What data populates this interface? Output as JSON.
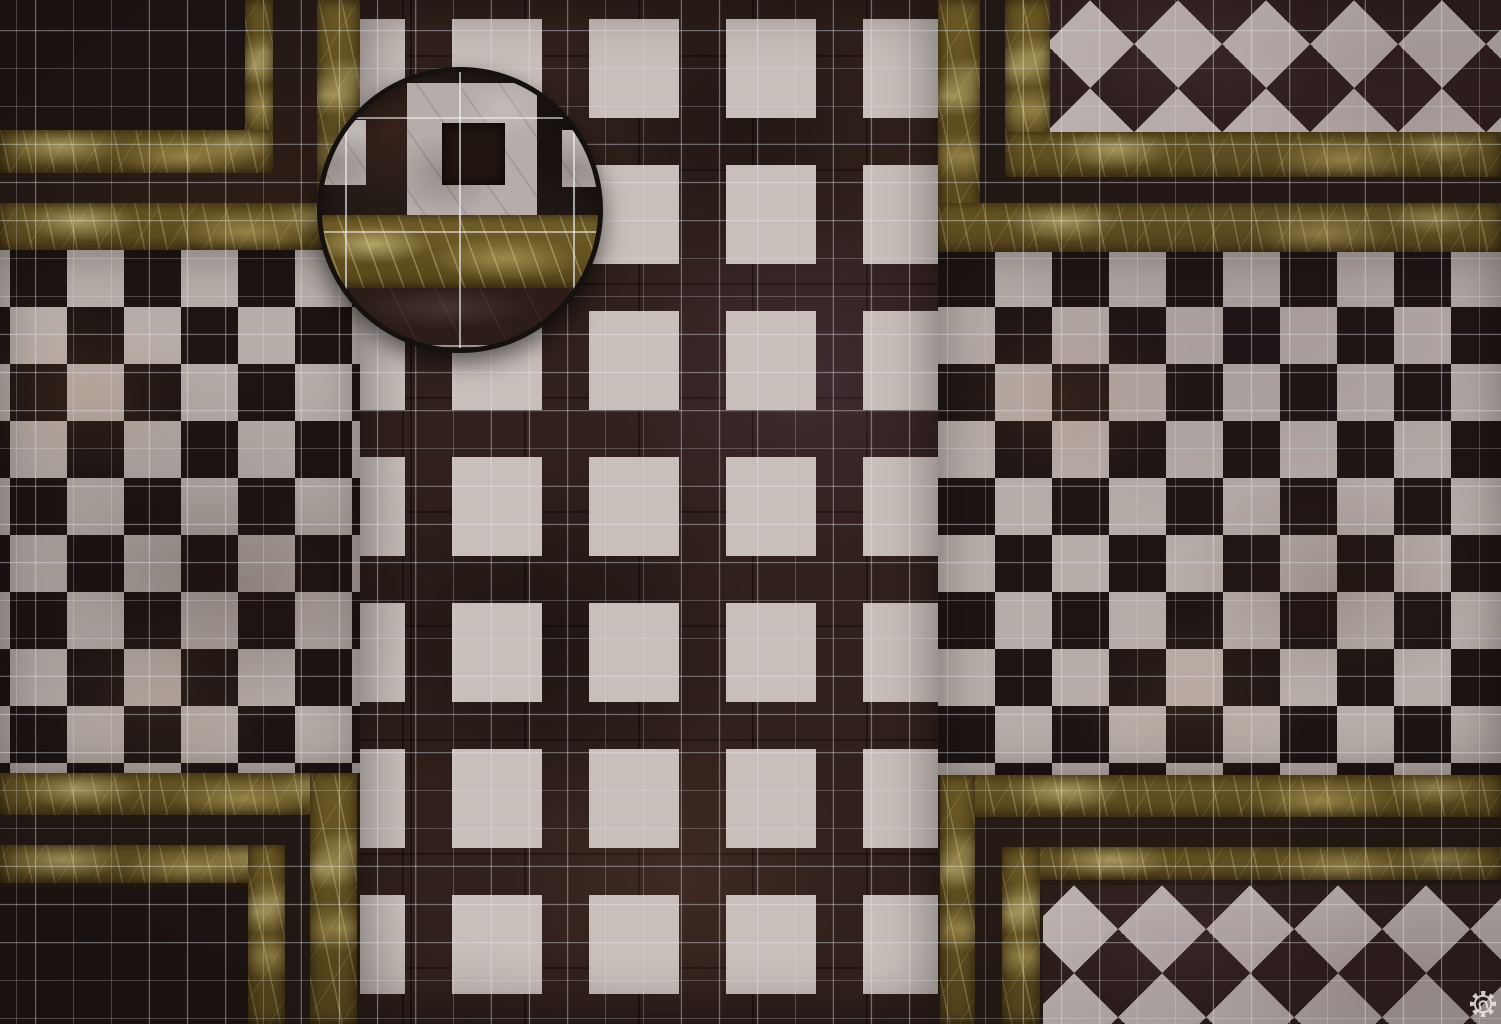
{
  "scene": {
    "type": "tabletop-battle-map",
    "subject": "Top-down marble palace floor battle map with square grid overlay, circular magnified-detail inset and publisher gear logo",
    "canvas_px": {
      "width": 1501,
      "height": 1024
    },
    "grid_overlay": {
      "cell_px": 38,
      "line_px": 1
    }
  },
  "palette": {
    "base_dark": "#221813",
    "corridor_marble": "#31211c",
    "accent_tile_white": "#c9bfba",
    "checker_white": "#b7ada8",
    "checker_black": "#1e1513",
    "motif_white": "#a9a19e",
    "motif_dark": "#241b17",
    "motif_hole": "#1d1412",
    "diamond_white": "#b9afac",
    "diamond_dark": "#2c1d1b",
    "gold_base": "#6a5824",
    "grid_line": "rgba(228,232,242,0.40)",
    "magnifier_rim": "#15110e"
  },
  "regions": {
    "corridor": [
      360,
      0,
      578,
      1024
    ],
    "checker_left": [
      0,
      250,
      360,
      523
    ],
    "checker_right": [
      938,
      250,
      563,
      525
    ],
    "motif_panel_top_left": [
      0,
      0,
      245,
      132
    ],
    "motif_panel_bottom_left": [
      0,
      887,
      248,
      137
    ],
    "diamond_panel_top_right": [
      1050,
      0,
      451,
      132
    ],
    "diamond_panel_bottom_right": [
      1043,
      885,
      458,
      139
    ]
  },
  "gold_bands": [
    {
      "name": "top-left-inner-vertical",
      "rect": [
        245,
        0,
        28,
        173
      ]
    },
    {
      "name": "top-left-inner-horizontal",
      "rect": [
        0,
        130,
        273,
        43
      ]
    },
    {
      "name": "top-left-outer-vertical",
      "rect": [
        317,
        0,
        43,
        250
      ]
    },
    {
      "name": "top-left-outer-horizontal",
      "rect": [
        0,
        203,
        360,
        47
      ]
    },
    {
      "name": "top-right-inner-vertical",
      "rect": [
        1005,
        0,
        45,
        177
      ]
    },
    {
      "name": "top-right-inner-horizontal",
      "rect": [
        1005,
        132,
        496,
        45
      ]
    },
    {
      "name": "top-right-outer-vertical",
      "rect": [
        938,
        0,
        42,
        252
      ]
    },
    {
      "name": "top-right-outer-horizontal",
      "rect": [
        938,
        203,
        563,
        49
      ]
    },
    {
      "name": "bottom-left-outer-horizontal",
      "rect": [
        0,
        773,
        357,
        42
      ]
    },
    {
      "name": "bottom-left-outer-vertical",
      "rect": [
        310,
        773,
        47,
        251
      ]
    },
    {
      "name": "bottom-left-inner-horizontal",
      "rect": [
        0,
        845,
        285,
        38
      ]
    },
    {
      "name": "bottom-left-inner-vertical",
      "rect": [
        248,
        845,
        37,
        179
      ]
    },
    {
      "name": "bottom-right-outer-horizontal",
      "rect": [
        940,
        775,
        561,
        42
      ]
    },
    {
      "name": "bottom-right-outer-vertical",
      "rect": [
        940,
        775,
        35,
        249
      ]
    },
    {
      "name": "bottom-right-inner-horizontal",
      "rect": [
        1002,
        847,
        499,
        33
      ]
    },
    {
      "name": "bottom-right-inner-vertical",
      "rect": [
        1002,
        847,
        38,
        177
      ]
    }
  ],
  "pattern_params": {
    "corridor_accent_tiles": {
      "tile_px": 47,
      "pitch_x_px": 137,
      "pitch_y_px": 146,
      "first_x": 405,
      "first_y": 118,
      "columns": 4
    },
    "checkerboard": {
      "cell_px": 57
    },
    "diamond_checker": {
      "cell_px": 88
    },
    "motif_tiles": {
      "tile_px": 55,
      "ring_outer_px": 38,
      "ring_inner_px": 22,
      "hole_px": 28
    }
  },
  "magnifier": {
    "rect": [
      317,
      67,
      286,
      286
    ],
    "magnification": "3x",
    "rim_px": 5,
    "details": {
      "big_tile": [
        85,
        11,
        130,
        132
      ],
      "big_tile_hole": [
        120,
        51,
        63,
        62
      ],
      "left_partial_tile": [
        -6,
        48,
        50,
        65
      ],
      "right_partial_tile": [
        240,
        58,
        42,
        57
      ],
      "gold_band": [
        -8,
        143,
        294,
        73
      ],
      "bottom_marble": [
        -8,
        216,
        294,
        66
      ]
    }
  },
  "logo": {
    "icon": "gear-with-n-monogram",
    "color": "#eceae6",
    "rect": [
      1469,
      990,
      28,
      28
    ]
  }
}
